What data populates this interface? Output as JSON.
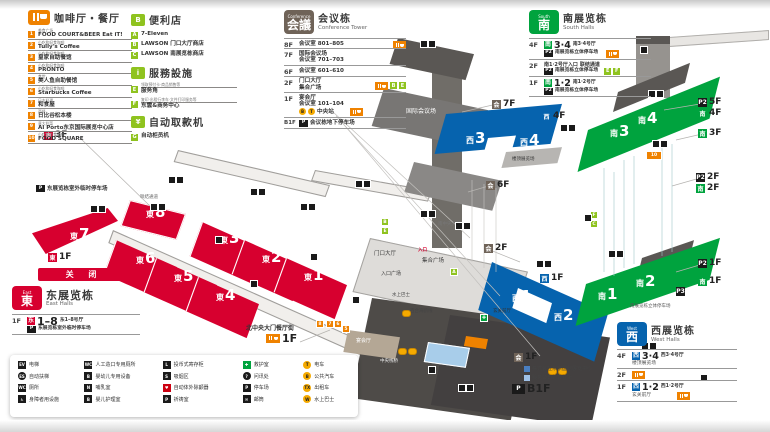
{
  "colors": {
    "east_red": "#d7002f",
    "west_blue": "#0663ae",
    "south_green": "#00a33e",
    "accent_orange": "#ef8200",
    "service_green": "#8fc31f",
    "conference_brown": "#6f6358"
  },
  "food_legend": {
    "title": "咖啡厅・餐厅",
    "items": [
      {
        "num": "1",
        "category": "美食广场",
        "name": "FOOD COURT&BEER Eat iT!"
      },
      {
        "num": "2",
        "category": "小吃和轻食咖啡",
        "name": "Tully's Coffee"
      },
      {
        "num": "3",
        "category": "小吃和轻食咖啡",
        "name": "皇家自助餐馆"
      },
      {
        "num": "4",
        "category": "小吃和轻食咖啡",
        "name": "PRONTO"
      },
      {
        "num": "5",
        "category": "食堂",
        "name": "美人鱼自助餐馆"
      },
      {
        "num": "6",
        "category": "小吃和轻食咖啡",
        "name": "Starbucks Coffee"
      },
      {
        "num": "7",
        "category": "日本料理",
        "name": "和食屋"
      },
      {
        "num": "8",
        "category": "西餐",
        "name": "日比谷松本楼"
      },
      {
        "num": "9",
        "category": "意大利菜",
        "name": "Al Porto东京国际展览中心店"
      },
      {
        "num": "10",
        "category": "小吃和轻食咖啡",
        "name": "FOOD SQUARE"
      }
    ]
  },
  "store_legend": {
    "title": "便利店",
    "items": [
      {
        "key": "A",
        "name": "7-Eleven"
      },
      {
        "key": "B",
        "name": "LAWSON 门口大厅商店"
      },
      {
        "key": "C",
        "name": "LAWSON 南展览栋商店"
      }
    ]
  },
  "service_legend": {
    "title": "服務設施",
    "items": [
      {
        "key": "E",
        "category": "领取预付卡·商品销售等",
        "name": "服务角"
      },
      {
        "key": "F",
        "category": "复印·出租行李车·文件打印服务等",
        "name": "东雲&商务中心"
      }
    ]
  },
  "atm_legend": {
    "title": "自动取款机",
    "items": [
      {
        "key": "G",
        "name": "自动柜员机"
      }
    ]
  },
  "conference": {
    "badge_small": "Conference",
    "badge": "会議",
    "title": "会议栋",
    "subtitle": "Conference Tower",
    "rows": [
      {
        "floor": "8F",
        "line1": "会议室 801–805"
      },
      {
        "floor": "7F",
        "line1": "国际会议场",
        "line2": "会议室 701–703"
      },
      {
        "floor": "6F",
        "line1": "会议室 601–610"
      },
      {
        "floor": "2F",
        "line1": "门口大厅",
        "line2": "集合广场"
      },
      {
        "floor": "1F",
        "line1": "宴会厅",
        "line2": "会议室 101–104",
        "line3": "中央站"
      },
      {
        "floor": "B1F",
        "line1": "会议栋地下停车场"
      }
    ]
  },
  "south_legend": {
    "badge_small": "South",
    "badge": "南",
    "title": "南展览栋",
    "subtitle": "South Halls",
    "rows": [
      {
        "floor": "4F",
        "hall_badge": "南",
        "hall_num": "3·4",
        "hall_label": "南3·4号厅",
        "parking": "南展览栋立体停车场"
      },
      {
        "floor": "2F",
        "line1": "南1·2号厅入口",
        "line2": "联结通道",
        "parking": "南展览栋立体停车场"
      },
      {
        "floor": "1F",
        "hall_badge": "南",
        "hall_num": "1·2",
        "hall_label": "南1·2号厅",
        "parking": "南展览栋立体停车场"
      }
    ]
  },
  "west_legend": {
    "badge_small": "West",
    "badge": "西",
    "title": "西展览栋",
    "subtitle": "West Halls",
    "rows": [
      {
        "floor": "4F",
        "hall_badge": "西",
        "hall_num": "3·4",
        "hall_label": "西3·4号厅",
        "note": "楼顶展览场"
      },
      {
        "floor": "2F"
      },
      {
        "floor": "1F",
        "hall_badge": "西",
        "hall_num": "1·2",
        "hall_label": "西1·2号厅",
        "note": "玄关前厅"
      }
    ]
  },
  "east_legend": {
    "closed": "关 闭",
    "badge_small": "East",
    "badge": "東",
    "title": "东展览栋",
    "subtitle": "East Halls",
    "floor": "1F",
    "hall_badge": "东",
    "hall_num": "1–8",
    "hall_label": "东1–8号厅",
    "parking": "东展览栋室外临时停车场"
  },
  "bottom_legend": {
    "columns": [
      [
        {
          "glyph": "EV",
          "label": "电梯"
        },
        {
          "glyph": "ES",
          "label": "自动扶梯"
        },
        {
          "glyph": "WC",
          "label": "厕所"
        },
        {
          "glyph": "♿",
          "label": "身障者用设施"
        }
      ],
      [
        {
          "glyph": "WC",
          "label": "人工造口专用厕所"
        },
        {
          "glyph": "B",
          "label": "婴幼儿专用设备"
        },
        {
          "glyph": "N",
          "label": "哺乳室"
        },
        {
          "glyph": "B",
          "label": "婴儿护理室"
        }
      ],
      [
        {
          "glyph": "L",
          "label": "投币式寄存柜"
        },
        {
          "glyph": "S",
          "label": "吸烟区"
        },
        {
          "glyph": "♥",
          "label": "自动体外除颤器"
        },
        {
          "glyph": "P",
          "label": "祈祷室"
        }
      ],
      [
        {
          "glyph": "✚",
          "label": "救护室"
        },
        {
          "glyph": "?",
          "label": "问讯处"
        },
        {
          "glyph": "P",
          "label": "停车场"
        },
        {
          "glyph": "✉",
          "label": "邮筒"
        }
      ],
      [
        {
          "glyph": "T",
          "label": "电车"
        },
        {
          "glyph": "B",
          "label": "公共汽车"
        },
        {
          "glyph": "TX",
          "label": "出租车"
        },
        {
          "glyph": "W",
          "label": "水上巴士"
        }
      ]
    ]
  },
  "map": {
    "halls": [
      {
        "prefix": "東",
        "num": "7"
      },
      {
        "prefix": "東",
        "num": "8"
      },
      {
        "prefix": "東",
        "num": "6"
      },
      {
        "prefix": "東",
        "num": "5"
      },
      {
        "prefix": "東",
        "num": "4"
      },
      {
        "prefix": "東",
        "num": "3"
      },
      {
        "prefix": "東",
        "num": "2"
      },
      {
        "prefix": "東",
        "num": "1"
      },
      {
        "prefix": "西",
        "num": "3"
      },
      {
        "prefix": "西",
        "num": "4"
      },
      {
        "prefix": "西",
        "num": "1"
      },
      {
        "prefix": "西",
        "num": "2"
      },
      {
        "prefix": "南",
        "num": "3"
      },
      {
        "prefix": "南",
        "num": "4"
      },
      {
        "prefix": "南",
        "num": "1"
      },
      {
        "prefix": "南",
        "num": "2"
      }
    ],
    "markers": [
      {
        "badge": "東",
        "text": "3F"
      },
      {
        "badge": "東",
        "text": "1F"
      },
      {
        "badge": "会",
        "text": "7F"
      },
      {
        "badge": "西",
        "text": "4F"
      },
      {
        "badge": "会",
        "text": "6F"
      },
      {
        "badge": "会",
        "text": "2F"
      },
      {
        "badge": "西",
        "text": "1F"
      },
      {
        "badge": "会",
        "text": "1F"
      },
      {
        "badge": "P2",
        "text": "5F"
      },
      {
        "badge": "南",
        "text": "4F"
      },
      {
        "badge": "南",
        "text": "3F"
      },
      {
        "badge": "P2",
        "text": "2F"
      },
      {
        "badge": "南",
        "text": "2F"
      },
      {
        "badge": "P2",
        "text": "1F"
      },
      {
        "badge": "南",
        "text": "1F"
      },
      {
        "badge": "P3",
        "text": ""
      },
      {
        "badge": "P",
        "text": "B1F"
      }
    ],
    "restaurant_street": {
      "label": "北中央大门餐厅街",
      "floor": "1F"
    },
    "building_note": {
      "company": "株式会社东京国际展览中心",
      "office": "服务公司的营业所"
    },
    "location_chips": [
      {
        "key": "A"
      },
      {
        "key": "B"
      },
      {
        "key": "E"
      },
      {
        "key": "F"
      },
      {
        "key": "C"
      },
      {
        "key": "8"
      },
      {
        "key": "7"
      },
      {
        "key": "6"
      },
      {
        "key": "5"
      },
      {
        "key": "10"
      }
    ],
    "labels": {
      "east_parking": "东展览栋室外临时停车场",
      "link_bridge": "联结通道",
      "intl_hall": "国际会议场",
      "entrance_hall": "门口大厅",
      "meeting_plaza": "集合广场",
      "entrance_plaza": "入口广场",
      "water_bus": "水上巴士",
      "yurikamome": "百合海鸥线",
      "central_hall": "南中央大厅",
      "roof_exhibit": "楼顶展览场",
      "foyer": "玄关前厅",
      "banquet": "宴会厅",
      "central_pier": "中央栈桥",
      "south_parking": "南展览栋立体停车场",
      "entrance": "入口"
    }
  }
}
